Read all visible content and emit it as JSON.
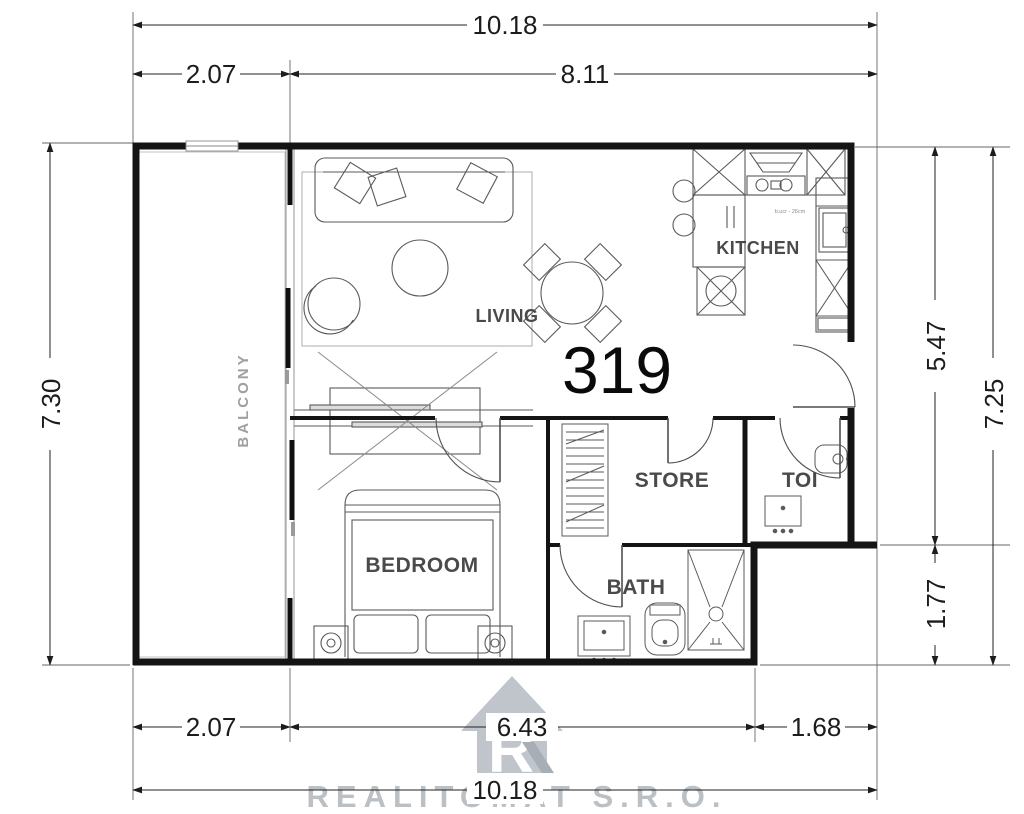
{
  "unit": {
    "number": "319"
  },
  "rooms": {
    "balcony": "BALCONY",
    "living": "LIVING",
    "kitchen": "KITCHEN",
    "bedroom": "BEDROOM",
    "store": "STORE",
    "toi": "TOI",
    "bath": "BATH"
  },
  "kitchen": {
    "note": "b.ucr - 26cm"
  },
  "dimensions": {
    "top_total": "10.18",
    "top_left": "2.07",
    "top_right": "8.11",
    "left_height": "7.30",
    "right_upper": "5.47",
    "right_lower": "1.77",
    "right_total": "7.25",
    "bottom_left": "2.07",
    "bottom_middle": "6.43",
    "bottom_right": "1.68",
    "bottom_total": "10.18"
  },
  "watermark": {
    "company": "REALITOMAT S.R.O.",
    "logo": "house-with-letter-R",
    "logo_color": "#b6bcc4",
    "text_color": "#9ca3ab"
  },
  "colors": {
    "walls": "#141414",
    "furniture_lines": "#5a5a5a",
    "dimension_lines": "#222222",
    "background": "#ffffff"
  }
}
